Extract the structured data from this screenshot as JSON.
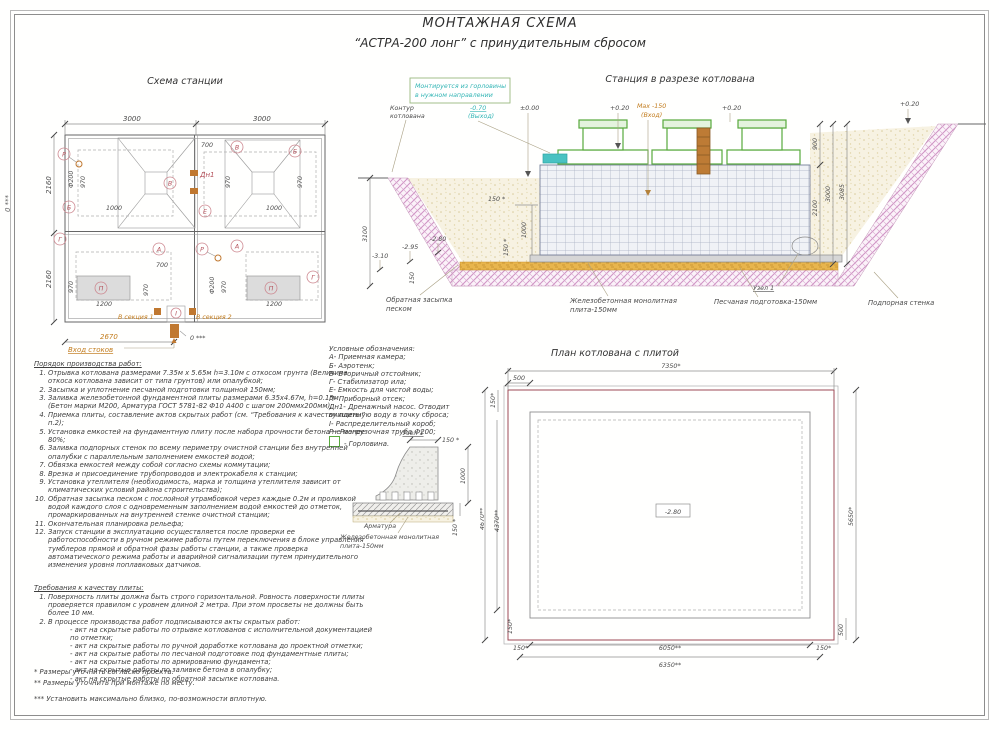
{
  "colors": {
    "accent_orange": "#c27c1e",
    "accent_teal": "#35b6b6",
    "accent_green": "#57a93c",
    "slope_hatch_pink": "#cf93c4",
    "pit_contour_red": "#9c4a55",
    "sand_layer_orange": "#e8b54d",
    "tag_red": "#b4505a"
  },
  "title": {
    "line1": "МОНТАЖНАЯ СХЕМА",
    "line2": "“АСТРА-200 лонг” с принудительным сбросом"
  },
  "station_plan": {
    "title": "Схема станции",
    "d3000": "3000",
    "d2160": "2160",
    "d700": "700",
    "d970": "970",
    "d1000": "1000",
    "d1200": "1200",
    "df200": "Ф200",
    "d2670": "2670",
    "inlet": "Вход стоков",
    "zero": "0 ***",
    "sec1": "В секция 1",
    "sec2": "В секция 2",
    "tags": {
      "A": "А",
      "B": "Б",
      "V": "В",
      "G": "Г",
      "E": "Е",
      "P": "П",
      "R": "Р",
      "I": "I",
      "Dn1": "Дн1"
    }
  },
  "cross_section": {
    "title": "Станция в разрезе котлована",
    "note1": "Монтируется из горловины",
    "note2": "в нужном направлении",
    "contour1": "Контур",
    "contour2": "котлована",
    "v070": "-0.70",
    "v070b": "(Выход)",
    "v000": "±0.00",
    "v020": "+0.20",
    "vmax": "Max -150",
    "vmaxb": "(Вход)",
    "d900": "900",
    "d3000": "3000",
    "d3085": "3085",
    "d2100": "2100",
    "d3100": "3100",
    "m310": "-3.10",
    "m295": "-2.95",
    "m280": "-2.80",
    "d150": "150",
    "d150s": "150 *",
    "d1000": "1000",
    "backfill1": "Обратная засыпка",
    "backfill2": "песком",
    "plate1": "Железобетонная монолитная",
    "plate2": "плита-150мм",
    "sand": "Песчаная подготовка-150мм",
    "wall": "Подпорная стенка",
    "node": "Узел 1"
  },
  "legend": {
    "title": "Условные обозначения:",
    "items": [
      "А- Приемная камера;",
      "Б- Аэротенк;",
      "В- Вторичный отстойник;",
      "Г- Стабилизатор ила;",
      "Е- Емкость для чистой воды;",
      "П- Приборный отсек;",
      "Дн1- Дренажный насос. Отводит",
      "очищенную воду в точку сброса;",
      "I- Распределительный короб;",
      "Р - Разгрузочная труба Ф200;",
      "- Горловина."
    ]
  },
  "node_detail": {
    "title": "Узел 1",
    "d150s": "150 *",
    "d1000": "1000",
    "rebar": "Арматура",
    "plate1": "Железобетонная монолитная",
    "plate2": "плита-150мм"
  },
  "pit_plan": {
    "title": "План котлована с плитой",
    "d7350": "7350*",
    "d500": "500",
    "d150": "150*",
    "d4670": "4670**",
    "d4370": "4370**",
    "d5650": "5650*",
    "d6050": "6050**",
    "d6350": "6350**",
    "mark": "-2.80"
  },
  "work_order": {
    "title": "Порядок производства работ:",
    "items": [
      "Отрывка котлована размерами 7.35м х 5.65м h=3.10м с откосом грунта (Величина откоса котлована зависит от типа грунтов) или опалубкой;",
      "Засыпка и уплотнение песчаной подготовки толщиной 150мм;",
      "Заливка железобетонной фундаментной плиты размерами 6.35х4.67м, h=0.15м. (Бетон марки М200, Арматура ГОСТ 5781-82 Ф10 А400 с шагом 200ммх200мм);",
      "Приемка плиты, составление актов скрытых работ (см. “Требования к качеству плиты” п.2);",
      "Установка емкостей на фундаментную плиту после набора прочности бетона не менее 80%;",
      "Заливка подпорных стенок по всему периметру очистной станции без внутренней опалубки с параллельным заполнением емкостей водой;",
      "Обвязка емкостей между собой согласно схемы коммутации;",
      "Врезка и присоединение трубопроводов и электрокабеля к станции;",
      "Установка утеплителя (необходимость, марка и толщина утеплителя зависит от климатических условий района строительства);",
      "Обратная засыпка песком с послойной утрамбовкой через каждые 0.2м и проливкой водой каждого слоя с одновременным заполнением водой емкостей до отметок, промаркированных на внутренней стенке очистной станции;",
      "Окончательная планировка рельефа;",
      "Запуск станции в эксплуатацию осуществляется после проверки ее работоспособности в ручном режиме работы путем переключения в блоке управления тумблеров прямой и обратной фазы работы станции, а также проверка автоматического режима работы и аварийной сигнализации путем принудительного изменения уровня поплавковых датчиков."
    ]
  },
  "plate_req": {
    "title": "Требования к качеству плиты:",
    "item1": "Поверхность плиты должна быть строго горизонтальной. Ровность поверхности плиты проверяется правилом с уровнем длиной 2 метра. При этом просветы не должны быть более 10 мм.",
    "item2": "В процессе производства работ подписываются акты скрытых работ:",
    "acts": [
      "- акт на скрытые работы по отрывке котлованов с исполнительной документацией по отметки;",
      "- акт на скрытые работы по ручной доработке котлована до проектной отметки;",
      "- акт на скрытые работы по песчаной подготовке под фундаментные плиты;",
      "- акт на скрытые работы по армированию фундамента;",
      "- акт на скрытые работы по заливке бетона в опалубку;",
      "- акт на скрытые работы по обратной засыпке котлована."
    ]
  },
  "footnotes": {
    "f1": "* Размеры уточнить согласно проекта.",
    "f2": "** Размеры уточнить при монтаже по месту.",
    "f3": "*** Установить максимально близко, по-возможности вплотную."
  }
}
